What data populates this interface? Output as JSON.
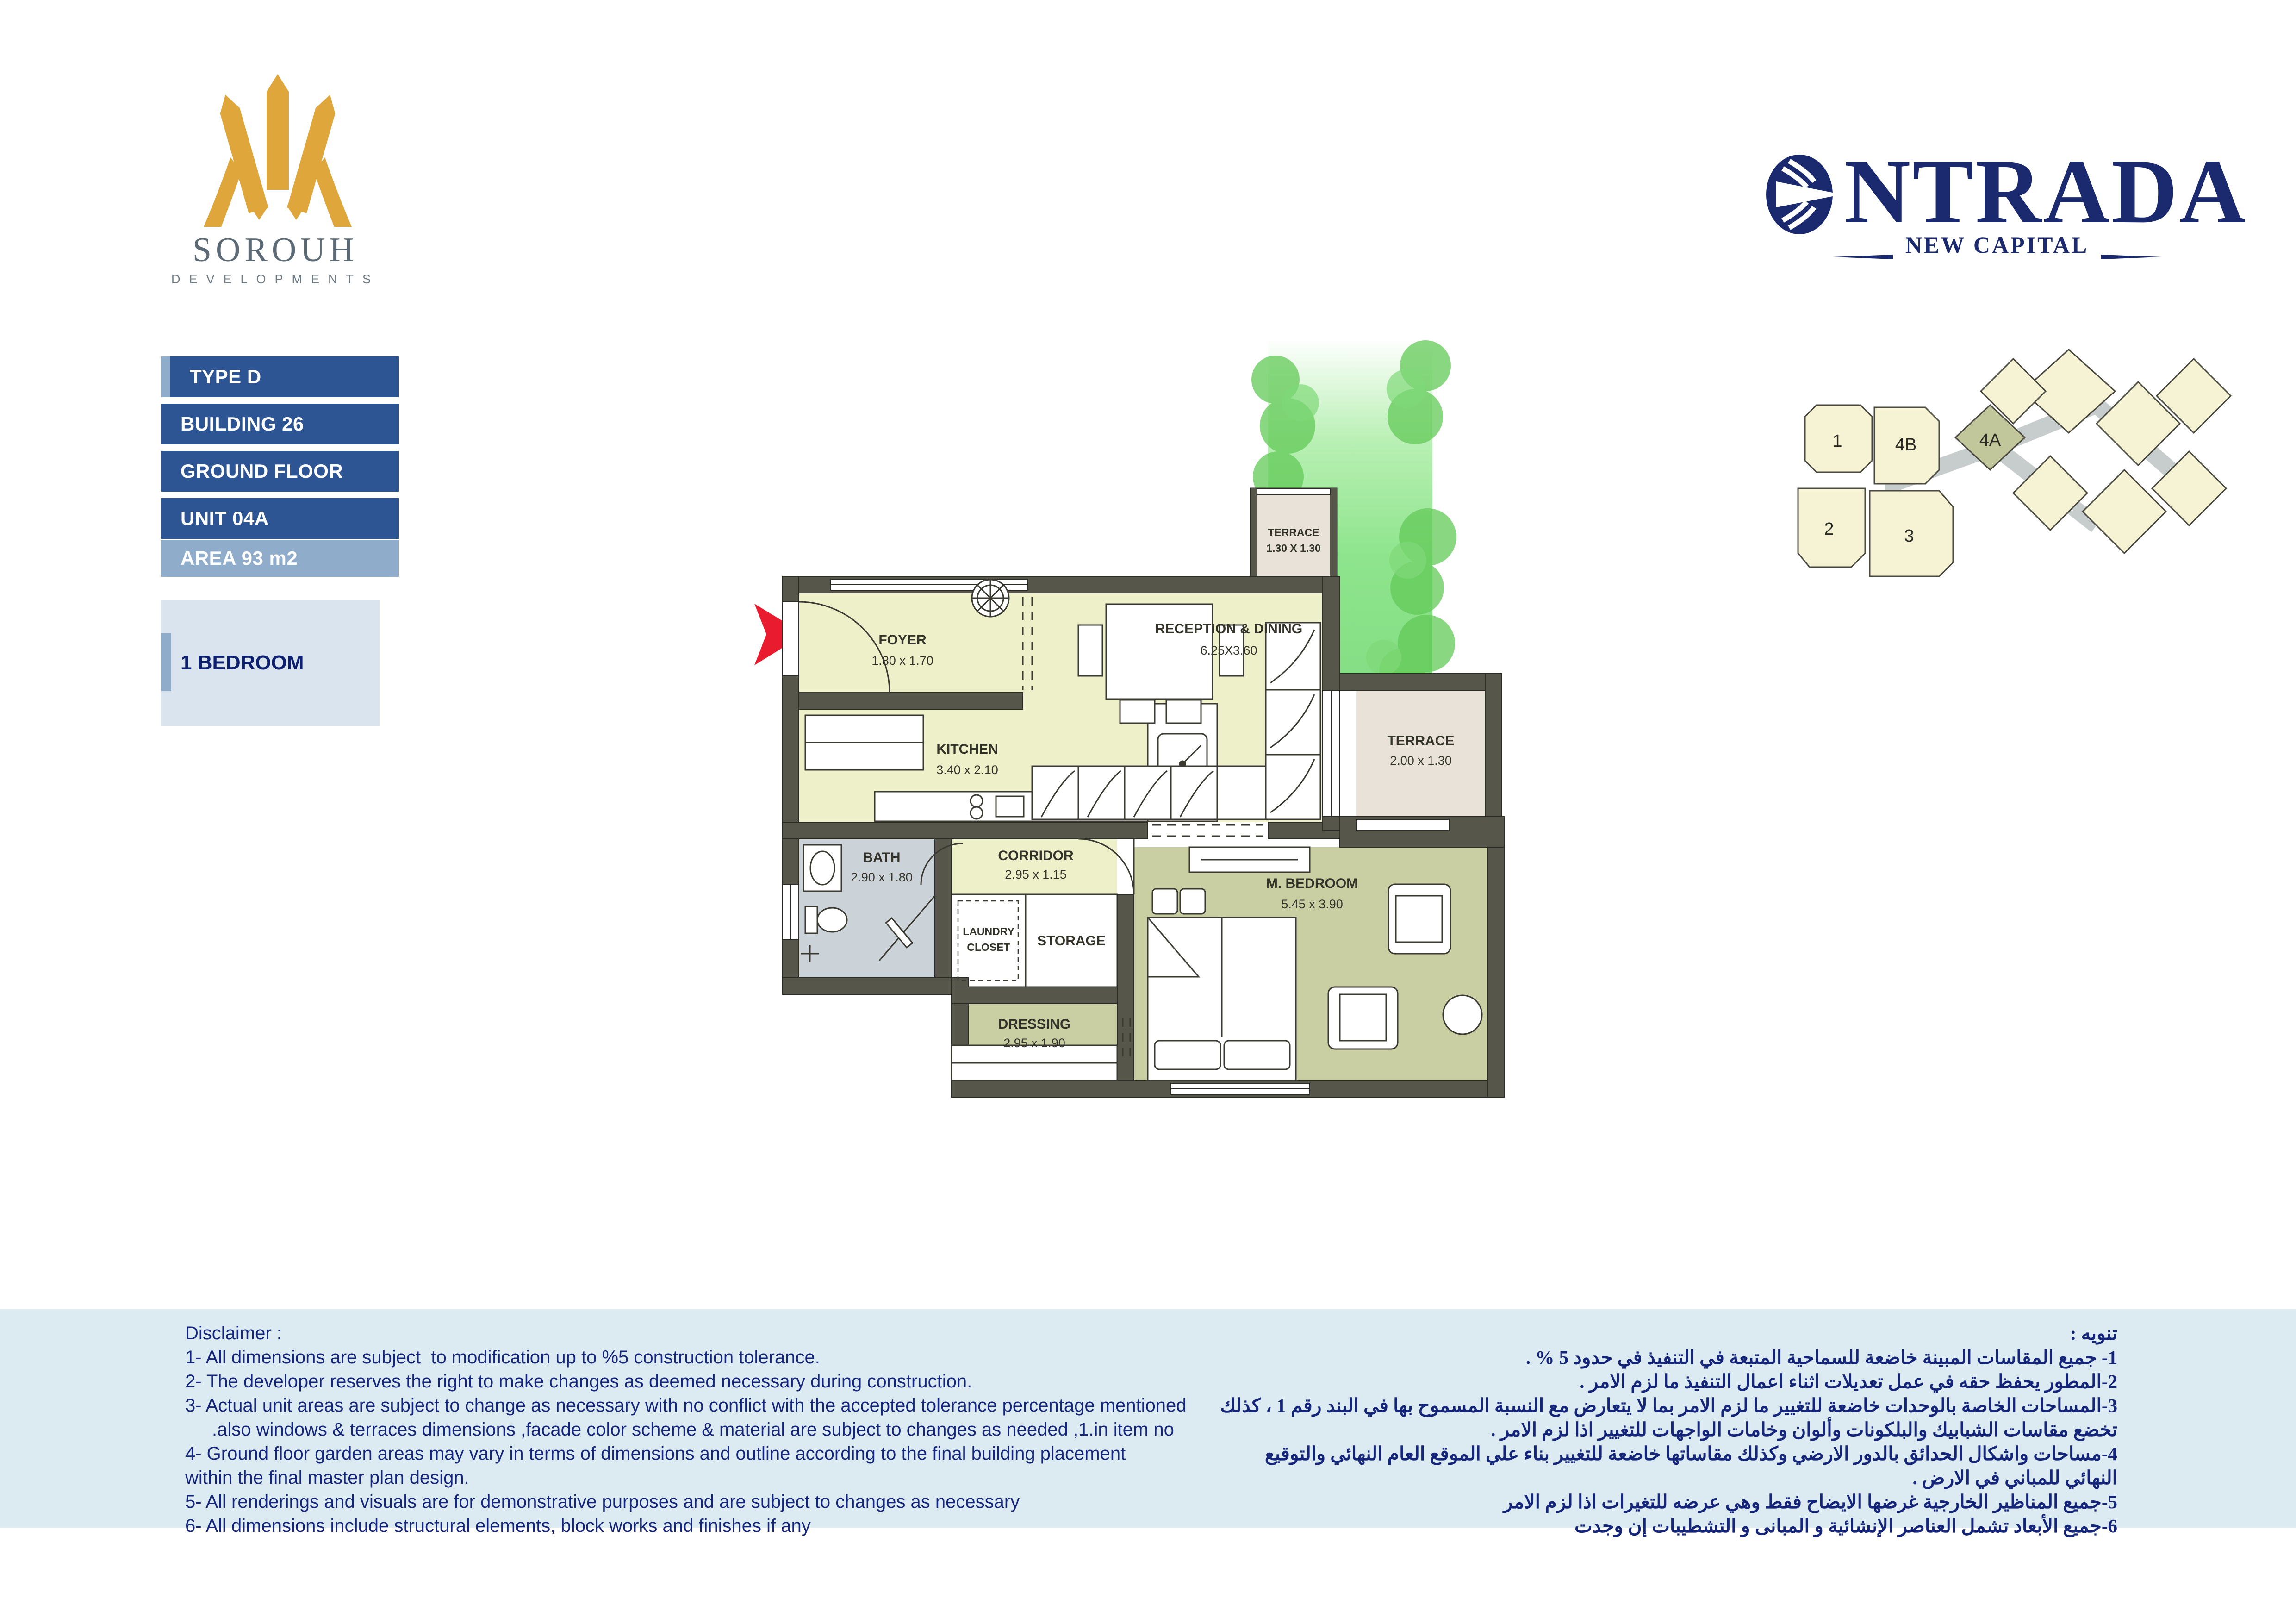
{
  "brand": {
    "developer_name": "SOROUH",
    "developer_sub": "DEVELOPMENTS",
    "project_name": "NTRADA",
    "project_sub": "NEW CAPITAL"
  },
  "unit_info": {
    "type": "TYPE D",
    "building": "BUILDING 26",
    "floor": "GROUND FLOOR",
    "unit": "UNIT 04A",
    "area": "AREA  93 m2",
    "bedroom": "1 BEDROOM"
  },
  "floor_plan": {
    "rooms": [
      {
        "name": "TERRACE",
        "dims": "1.30 X 1.30"
      },
      {
        "name": "FOYER",
        "dims": "1.80 x 1.70"
      },
      {
        "name": "RECEPTION & DINING",
        "dims": "6.25X3.60"
      },
      {
        "name": "KITCHEN",
        "dims": "3.40 x 2.10"
      },
      {
        "name": "TERRACE",
        "dims": "2.00 x 1.30"
      },
      {
        "name": "BATH",
        "dims": "2.90 x 1.80"
      },
      {
        "name": "CORRIDOR",
        "dims": "2.95 x 1.15"
      },
      {
        "name": "LAUNDRY CLOSET",
        "name_line1": "LAUNDRY",
        "name_line2": "CLOSET",
        "dims": ""
      },
      {
        "name": "STORAGE",
        "dims": ""
      },
      {
        "name": "DRESSING",
        "dims": "2.95 x 1.90"
      },
      {
        "name": "M. BEDROOM",
        "dims": "5.45 x 3.90"
      }
    ]
  },
  "site_plan": {
    "buildings": [
      "1",
      "4B",
      "4A",
      "2",
      "3"
    ],
    "highlighted": "4A"
  },
  "disclaimer_en": {
    "lines": [
      "Disclaimer :",
      "1- All dimensions are subject  to modification up to %5 construction tolerance.",
      "2- The developer reserves the right to make changes as deemed necessary during construction.",
      "3- Actual unit areas are subject to change as necessary with no conflict with the accepted tolerance percentage mentioned",
      ".also windows & terraces dimensions ,facade color scheme & material are subject to changes as needed ,1.in item no",
      "4- Ground floor garden areas may vary in terms of dimensions and outline according to the final building placement",
      "within the final master plan design.",
      "5- All renderings and visuals are for demonstrative purposes and are subject to changes as necessary",
      "6- All dimensions include structural elements, block works and finishes if any"
    ]
  },
  "disclaimer_ar": {
    "lines": [
      "تنويه :",
      "1- جميع المقاسات المبينة خاضعة للسماحية المتبعة في التنفيذ في حدود 5 % .",
      "2-المطور يحفظ حقه في عمل تعديلات اثناء اعمال التنفيذ ما لزم الامر .",
      "3-المساحات الخاصة بالوحدات خاضعة للتغيير ما لزم الامر بما لا يتعارض مع النسبة المسموح بها في البند رقم 1 ، كذلك",
      "تخضع مقاسات الشبابيك والبلكونات وألوان وخامات الواجهات للتغيير اذا لزم الامر .",
      "4-مساحات واشكال الحدائق بالدور الارضي وكذلك مقاساتها خاضعة للتغيير بناء علي الموقع العام النهائي والتوقيع",
      "النهائي للمباني في الارض .",
      "5-جميع المناظير الخارجية غرضها الايضاح فقط وهي عرضه للتغيرات اذا لزم الامر",
      "6-جميع الأبعاد تشمل العناصر الإنشائية و المبانى و التشطيبات إن وجدت"
    ]
  },
  "colors": {
    "primary_blue": "#2e5593",
    "light_blue": "#8fadcb",
    "pale_blue_box": "#d9e4ee",
    "disclaimer_bg": "#dceaf2",
    "navy_text": "#15267a",
    "logo_gold": "#dfa63c",
    "wall": "#56574a",
    "floor_yellow": "#eef0ca",
    "floor_olive": "#c9cfa3",
    "floor_gray": "#ccd3d8",
    "floor_beige": "#e8e2d8",
    "garden_green": "#8ce08d",
    "arrow_red": "#e81c2e"
  }
}
